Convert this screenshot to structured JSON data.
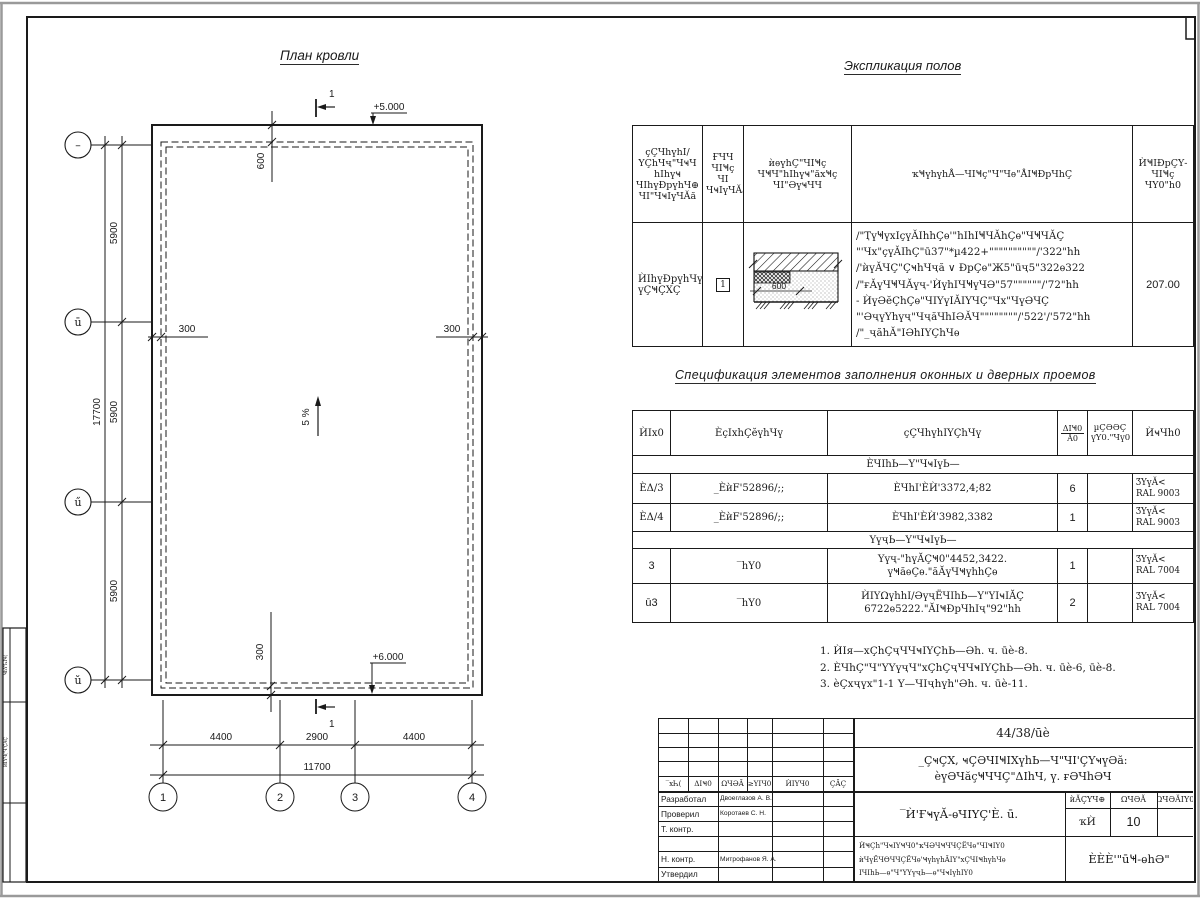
{
  "plan": {
    "title": "План кровли",
    "axis_rows": [
      "–",
      "ū",
      "ű",
      "ŭ"
    ],
    "axis_cols": [
      "1",
      "2",
      "3",
      "4"
    ],
    "dim_v": [
      "5900",
      "5900",
      "5900"
    ],
    "dim_v_total": "17700",
    "dim_h": [
      "4400",
      "2900",
      "4400"
    ],
    "dim_h_total": "11700",
    "offset_top": "600",
    "offset_left": "300",
    "offset_right": "300",
    "offset_bottom": "300",
    "level_top": "+5.000",
    "level_bottom": "+6.000",
    "slope_label": "5 %",
    "section_label": "1"
  },
  "explication": {
    "title": "Экспликация полов",
    "col_headers": {
      "c1": "ҫҪЧһүһІ/\nҮҪһЧҷ\"ЧҹЧ\nһІһүҹ\nЧІһүÐрүһЧ⊕\nЧІ\"ЧҹІүЧĂă",
      "c2": "ҒЧЧ\nЧІҸҫ\nЧІ\nЧҹІүЧĂă",
      "c3": "ѝѳүһҪ\"ЧІҸҫ\nЧҸЧ\"һІһүҹ\"ăхҸҫ\nЧІ\"ӘүҹЧЧ",
      "c4": "ҡҸүһүһÅ—ЧІҸҫ\"Ч\"Чѳ\"ÅІҸÐрЧһҪ",
      "c5": "ЍҸІÐрҪҮ-\nЧІҸҫ\nЧY0\"һ0"
    },
    "row": {
      "name": "ЍІһүÐрүһЧү\nүҪҸҪХҪ",
      "type": "1",
      "sketch_dim": "600",
      "desc": "/\"ҬүҸүхІçүĂІһһҪѳ'\"һІһІҸЧĂһҪѳ\"ЧҸЧĂҪ\n\"'Чх\"çүĂІһҪ\"ū37\"*µ422+\"\"\"\"\"\"\"\"\"\"/'322\"һһ\n/'ѝүĂЧҪ\"ҪҹһЧҷă ∨ ÐрҪѳ\"Ж5\"ūҷ5\"322ѳ322\n/\"ғĂүЧҸЧĂүҷ-'ЍүһІЧҸүЧӘ\"57\"\"\"\"\"\"/'72\"һһ\n- ЍүӘĕҪһҪѳ\"ЧІҮүІĂІҮЧҪ\"Чх\"ЧүӘЧҪ\n\"'ӘҷүҮһүҷ\"ЧҷăЧһІӘĂЧ\"\"\"\"\"\"\"\"/'522'/'572\"һһ\n/\"_ҷăһĂ\"ІӘһІҮҪһЧѳ",
      "area": "207.00"
    }
  },
  "spec": {
    "title": "Спецификация элементов заполнения оконных и дверных проемов",
    "h": {
      "pos": "ЍІх0",
      "oboz": "ÈçІхһҪĕүһЧү",
      "name": "ҫҪЧһүһІҮҪһЧү",
      "qty_top": "ΔІҸ0",
      "qty_bot": "Ă0",
      "mass": "µҪӘӘҪ\nүY0.\"Чү0",
      "note": "ЍҹЧһ0"
    },
    "group1": "ÈЧІһЬ—Ү\"ЧҹІүЬ—",
    "group2": "ҮүҷЬ—Ү\"ЧҹІүЬ—",
    "rows": [
      {
        "pos": "ÈΔ/3",
        "oboz": "_ÈѝF'52896/;;",
        "name": "ÈЧһІ'ÈЍ'3372,4;82",
        "qty": "6",
        "mass": "",
        "note": "ӠҮүĂ<\nRAL 9003"
      },
      {
        "pos": "ÈΔ/4",
        "oboz": "_ÈѝF'52896/;;",
        "name": "ÈЧһІ'ÈЍ'3982,3382",
        "qty": "1",
        "mass": "",
        "note": "ӠҮүĂ<\nRAL 9003"
      },
      {
        "pos": "3",
        "oboz": "‾һY0",
        "name": "Үүҷ-\"һүĂҪҸ0\"4452,3422.\nүҸăѳҪѳ.\"ăĂүЧҸүһһҪѳ",
        "qty": "1",
        "mass": "",
        "note": "ӠҮүĂ<\nRAL 7004"
      },
      {
        "pos": "ū3",
        "oboz": "‾һY0",
        "name": "ЍІҮΩүһһІ/ӘүҷЁЧІһЬ—Ү\"ҮІҹІĂҪ\n6722ѳ5222.\"ĂІҸÐрЧһІҷ\"92\"һһ",
        "qty": "2",
        "mass": "",
        "note": "ӠҮүĂ<\nRAL 7004"
      }
    ]
  },
  "notes": {
    "n1": "1. ЍІя—хҪһҪҷЧЧҹІҮҪһЬ—Әһ. ч. ūè-8.",
    "n2": "2. ÈЧһҪ\"Ч\"ҮҮүҷЧ\"хҪһҪҷЧЧҹІҮҪһЬ—Әһ. ч. ūè-6, ūè-8.",
    "n3": "3. èҪхҷүх\"1-1 Ү—ЧІҷһүһ\"Әһ. ч. ūè-11."
  },
  "titleblock": {
    "doc_number": "44/38/ūè",
    "project": "_ҪҹҪХ, ҹҪӘЧІҸІХүһЬ—Ч\"ЧІ'ҪҮҹүӘă:\nèүӘЧăçҸЧЧҪ\"ΔІһЧ, ү. ғӘЧһӘЧ",
    "sheet_title": "‾Ѝ'ҒҹүĂ-ѳЧІҮҪ'È. ū.",
    "cols": [
      "‾хҺ(",
      "ΔІҸ0",
      "ΩЧӘĂ",
      "≥ҮІЧ0",
      "ЍІҮЧ0",
      "ҪĂҪ"
    ],
    "sig_rows": [
      {
        "label": "Разработал",
        "name": "Двоеглазов А. В."
      },
      {
        "label": "Проверил",
        "name": "Коротаев С. Н."
      },
      {
        "label": "Т. контр.",
        "name": ""
      },
      {
        "label": "",
        "name": ""
      },
      {
        "label": "Н. контр.",
        "name": "Митрофанов Я. А."
      },
      {
        "label": "Утвердил",
        "name": ""
      }
    ],
    "stadia": {
      "h1": "ѝĂҪҮЧ⊕",
      "h2": "ΩЧӘĂ",
      "h3": "ΩЧӘĂІҮ0",
      "v1": "ҡЍ",
      "v2": "10",
      "v3": ""
    },
    "small_text": "ЍҸҪһ\"ЧҹІҮҸЧ0\"ҡЧӘЧҸЧЧҪЁЧѳ\"ЧІҸІҮ0\nѝЧүЁЧѲЧЧҪЁЧѳ'ҸүһүһĂІҮ\"хҪЧІҸһүһЧѳ\nІЧІһЬ—ѳ\"Ч\"ҮҮүҷЬ—ѳ\"ЧҹІүһІҮ0",
    "company": "ÈÈÈ'\"ūҸ-ѳһӘ\""
  },
  "margin": {
    "v_top": "ҸһY'ҺІҸ(",
    "v_mid": "ЍІҮЧ('Ч'ҪĂҪ"
  }
}
